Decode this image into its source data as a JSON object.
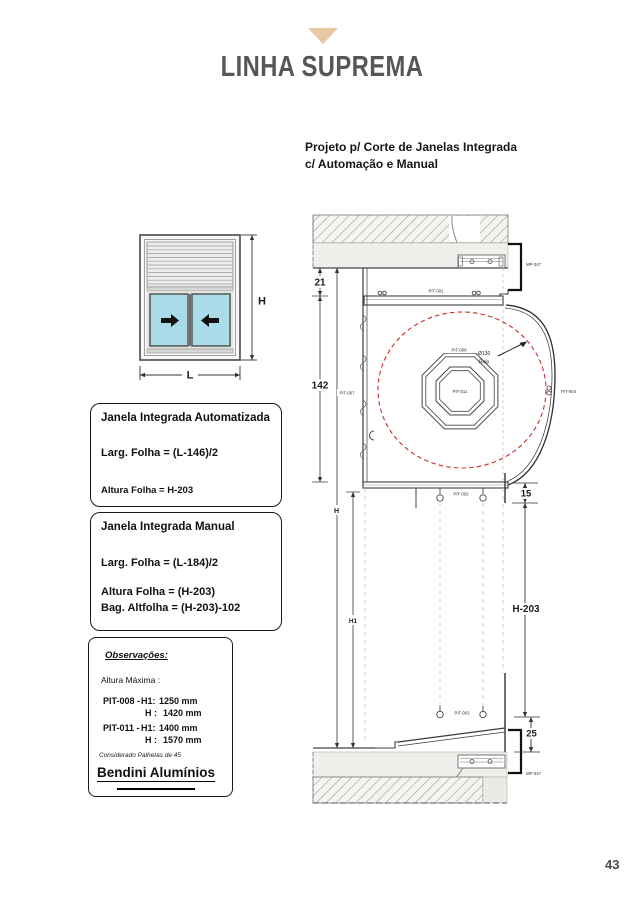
{
  "header": {
    "title": "LINHA SUPREMA"
  },
  "subheading": {
    "line1": "Projeto p/ Corte de Janelas Integrada",
    "line2": "c/ Automação e Manual"
  },
  "window_diagram": {
    "height_label": "H",
    "width_label": "L"
  },
  "box_auto": {
    "title": "Janela Integrada Automatizada",
    "width_formula": "Larg. Folha = (L-146)/2",
    "height_formula": "Altura Folha = H-203"
  },
  "box_manual": {
    "title": "Janela Integrada Manual",
    "width_formula": "Larg. Folha = (L-184)/2",
    "height_formula": "Altura Folha = (H-203)",
    "bag_formula": "Bag. Altfolha = (H-203)-102"
  },
  "box_notes": {
    "title": "Observações:",
    "subtitle": "Altura Máxima :",
    "rows": [
      {
        "code": "PIT-008 -",
        "h1_label": "H1:",
        "h1_value": "1250 mm",
        "h_label": "H :",
        "h_value": "1420 mm"
      },
      {
        "code": "PIT-011 -",
        "h1_label": "H1:",
        "h1_value": "1400 mm",
        "h_label": "H :",
        "h_value": "1570 mm"
      }
    ],
    "footnote": "Considerado Palhetas de 45",
    "brand": "Bendini Alumínios"
  },
  "drawing": {
    "dims": {
      "top_gap": "21",
      "shutter_box": "142",
      "sill_gap": "15",
      "frame_height": "H-203",
      "bottom_gap": "25",
      "total_height": "H",
      "inner_height": "H1"
    },
    "labels": {
      "top_profile": "PIT-001",
      "bottom_profile": "PIT-002",
      "sill_profile": "PIT-003",
      "side_profile": "PIT-004",
      "left_profile": "PIT-007",
      "shutter_slat": "PIT-008",
      "axle": "PIT-011",
      "diameter": "Ø130",
      "roll": "Rolo",
      "bracket_top": "MP-347",
      "bracket_bottom": "MP-347"
    }
  },
  "footer": {
    "page_number": "43"
  },
  "colors": {
    "accent_tan": "#e7c8a2",
    "title_gray": "#57575a",
    "glass_blue": "#a9dbe9",
    "drum_red": "#c83028"
  }
}
